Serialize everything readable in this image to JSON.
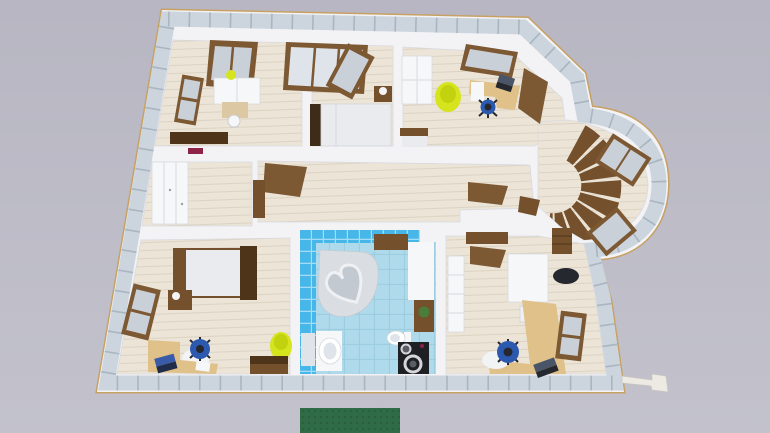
{
  "scene": {
    "title": "3D top-down render of an apartment floor plan",
    "rooms": [
      {
        "name": "top-left-bedroom",
        "furniture": [
          "left-wall-window",
          "top-wall-window",
          "white-dresser",
          "yellow-vase",
          "writing-desk",
          "white-chair",
          "dark-sideboard",
          "magenta-wall-box"
        ]
      },
      {
        "name": "master-bedroom",
        "furniture": [
          "open-balcony-door",
          "double-bed",
          "dark-headboard",
          "nightstand",
          "table-lamp"
        ]
      },
      {
        "name": "top-right-study",
        "furniture": [
          "white-wardrobe",
          "yellow-bean-bag",
          "top-wall-window",
          "corner-desk",
          "white-drawer-unit",
          "laptop",
          "blue-office-chair",
          "single-bed",
          "open-door"
        ]
      },
      {
        "name": "walk-in-closet",
        "furniture": [
          "white-sliding-wardrobe"
        ]
      },
      {
        "name": "hallway",
        "furniture": [
          "open-door-leaf",
          "open-door-leaf",
          "open-door-leaf"
        ]
      },
      {
        "name": "stair-tower",
        "furniture": [
          "spiral-staircase",
          "curved-bay-window",
          "curved-bay-window",
          "brown-shelf",
          "dark-bag"
        ]
      },
      {
        "name": "bottom-left-bedroom",
        "furniture": [
          "single-bed",
          "nightstand-with-lamp",
          "left-wall-window",
          "corner-desk",
          "laptop",
          "blue-office-chair",
          "white-rug",
          "yellow-bean-bag",
          "brown-dresser"
        ]
      },
      {
        "name": "bathroom",
        "furniture": [
          "heart-shaped-bathtub",
          "washbasin",
          "wall-mirror",
          "toilet",
          "washing-machine",
          "plant-cabinet",
          "brown-shelf"
        ]
      },
      {
        "name": "bottom-right-office",
        "furniture": [
          "l-shaped-desk",
          "laptop",
          "blue-office-chair",
          "white-rug",
          "white-shelving",
          "white-wardrobe",
          "ac-unit",
          "right-wall-window",
          "brown-wall-shelf"
        ]
      },
      {
        "name": "exterior",
        "furniture": [
          "green-doormat",
          "white-drain-pipe"
        ]
      }
    ]
  },
  "colors": {
    "background": "#b7b6c2",
    "background_bottom": "#c3c2cc",
    "outline_gold": "#c7a163",
    "wall_tile": "#ccd5dd",
    "wall_tile_seam": "#a9b5c0",
    "wall_white": "#f3f3f6",
    "wall_shade": "#d9dae0",
    "floor_wood": "#ebe4d7",
    "floor_plank_line": "#dcd3c2",
    "wood_dark": "#4e3419",
    "wood_mid": "#74512c",
    "wood_door": "#7c5833",
    "wood_desk": "#dfc189",
    "desk_pale": "#dcc9a4",
    "white_furniture": "#f6f7f9",
    "bed_white": "#e9ebef",
    "headboard_dark": "#3f2c18",
    "yellow": "#d6e41e",
    "yellow_dark": "#c2d20e",
    "chair_blue": "#2b59b0",
    "chair_dark": "#25282e",
    "bath_wall": "#47b7e9",
    "bath_grout": "#a5dcf4",
    "bath_floor": "#aedaeb",
    "bath_floor_line": "#9accdf",
    "tub_rim": "#dadde2",
    "tub_basin": "#c3c9d1",
    "tub_inner_line": "#eef0f3",
    "washer_dark": "#1e2023",
    "washer_ring": "#d4d6da",
    "washer_drum": "#595d66",
    "magenta": "#8e2247",
    "plant_green": "#4a7d3a",
    "mat_green": "#2f6b46",
    "mat_green_dark": "#27593a",
    "glass": "#c9d0d8",
    "glass_light": "#dfe4ea",
    "rug_white": "#f2f3f5",
    "lamp_white": "#f4f4f6",
    "ac_white": "#eef0f3",
    "pipe_white": "#edeae4"
  }
}
